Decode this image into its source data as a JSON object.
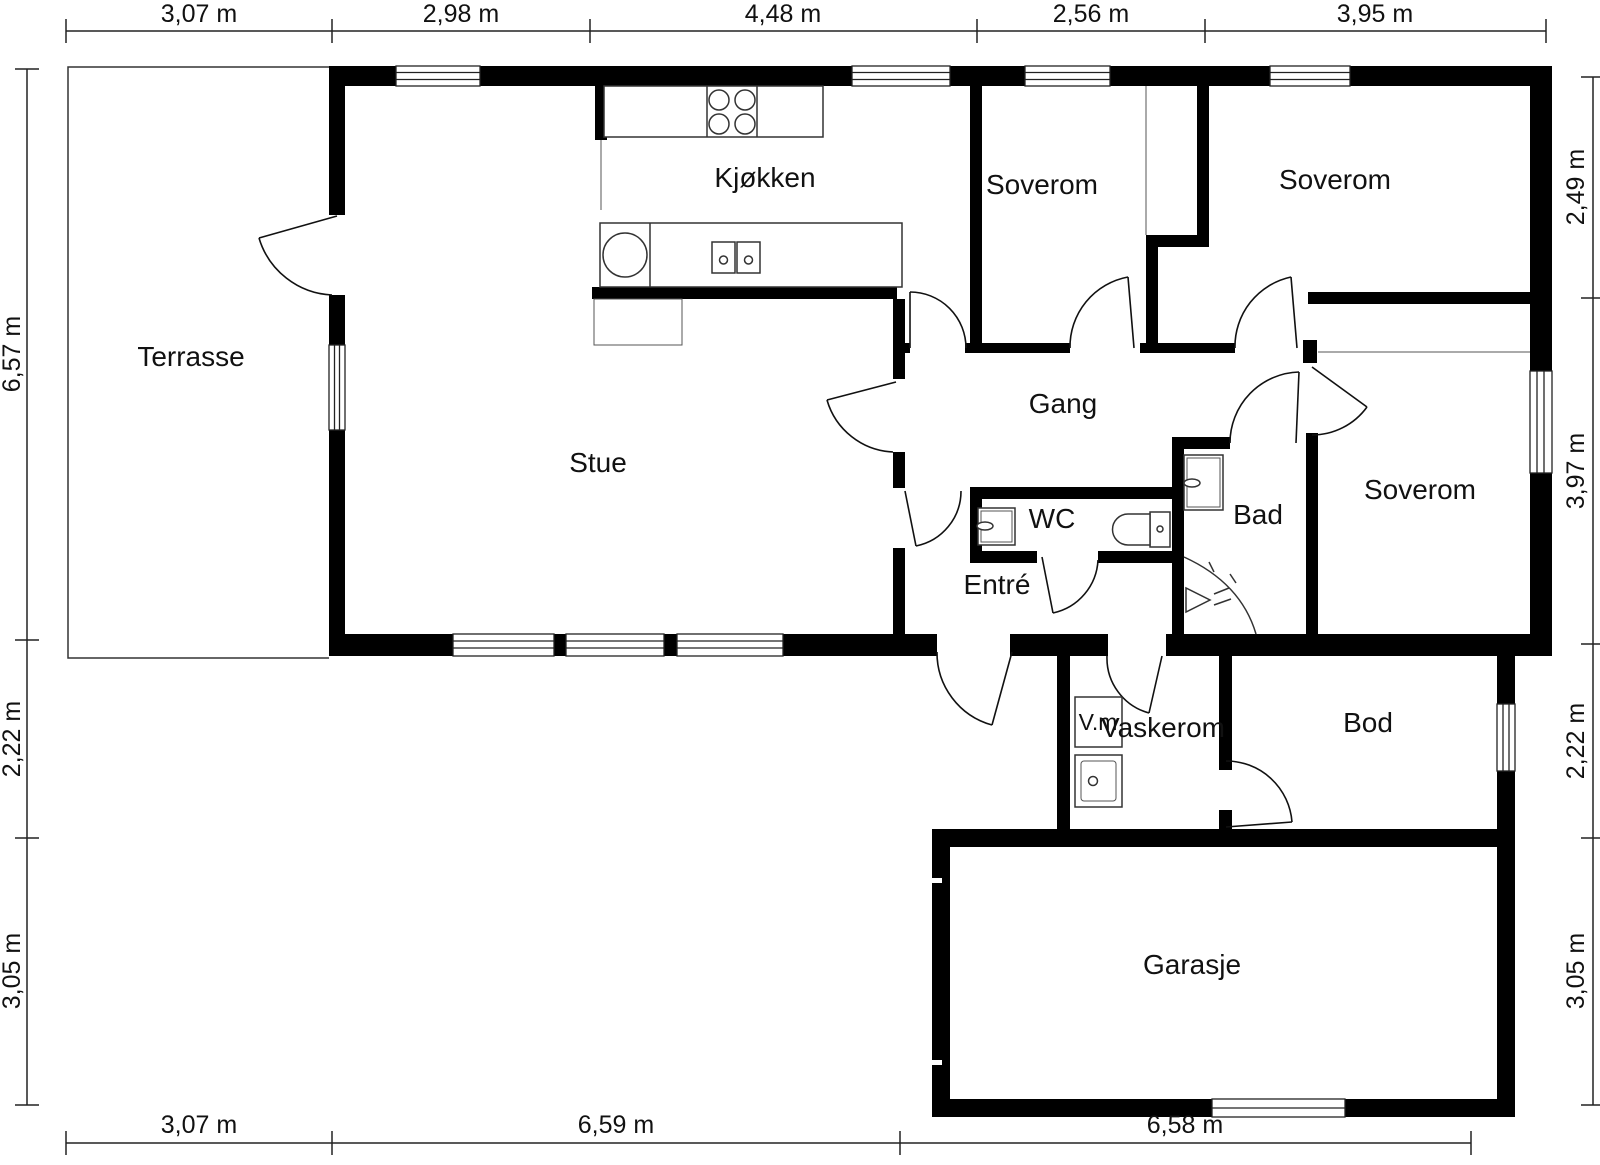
{
  "rooms": {
    "terrasse": "Terrasse",
    "stue": "Stue",
    "kjokken": "Kjøkken",
    "soverom1": "Soverom",
    "soverom2": "Soverom",
    "soverom3": "Soverom",
    "gang": "Gang",
    "wc": "WC",
    "bad": "Bad",
    "entre": "Entré",
    "vm": "V.m",
    "vaskerom": "Vaskerom",
    "bod": "Bod",
    "garasje": "Garasje"
  },
  "dims": {
    "top": [
      "3,07 m",
      "2,98 m",
      "4,48 m",
      "2,56 m",
      "3,95 m"
    ],
    "bottom": [
      "3,07 m",
      "6,59 m",
      "6,58 m"
    ],
    "left": [
      "6,57 m",
      "2,22 m",
      "3,05 m"
    ],
    "right": [
      "2,49 m",
      "3,97 m",
      "2,22 m",
      "3,05 m"
    ]
  },
  "colors": {
    "wall": "#000000",
    "background": "#ffffff",
    "line": "#222222"
  }
}
